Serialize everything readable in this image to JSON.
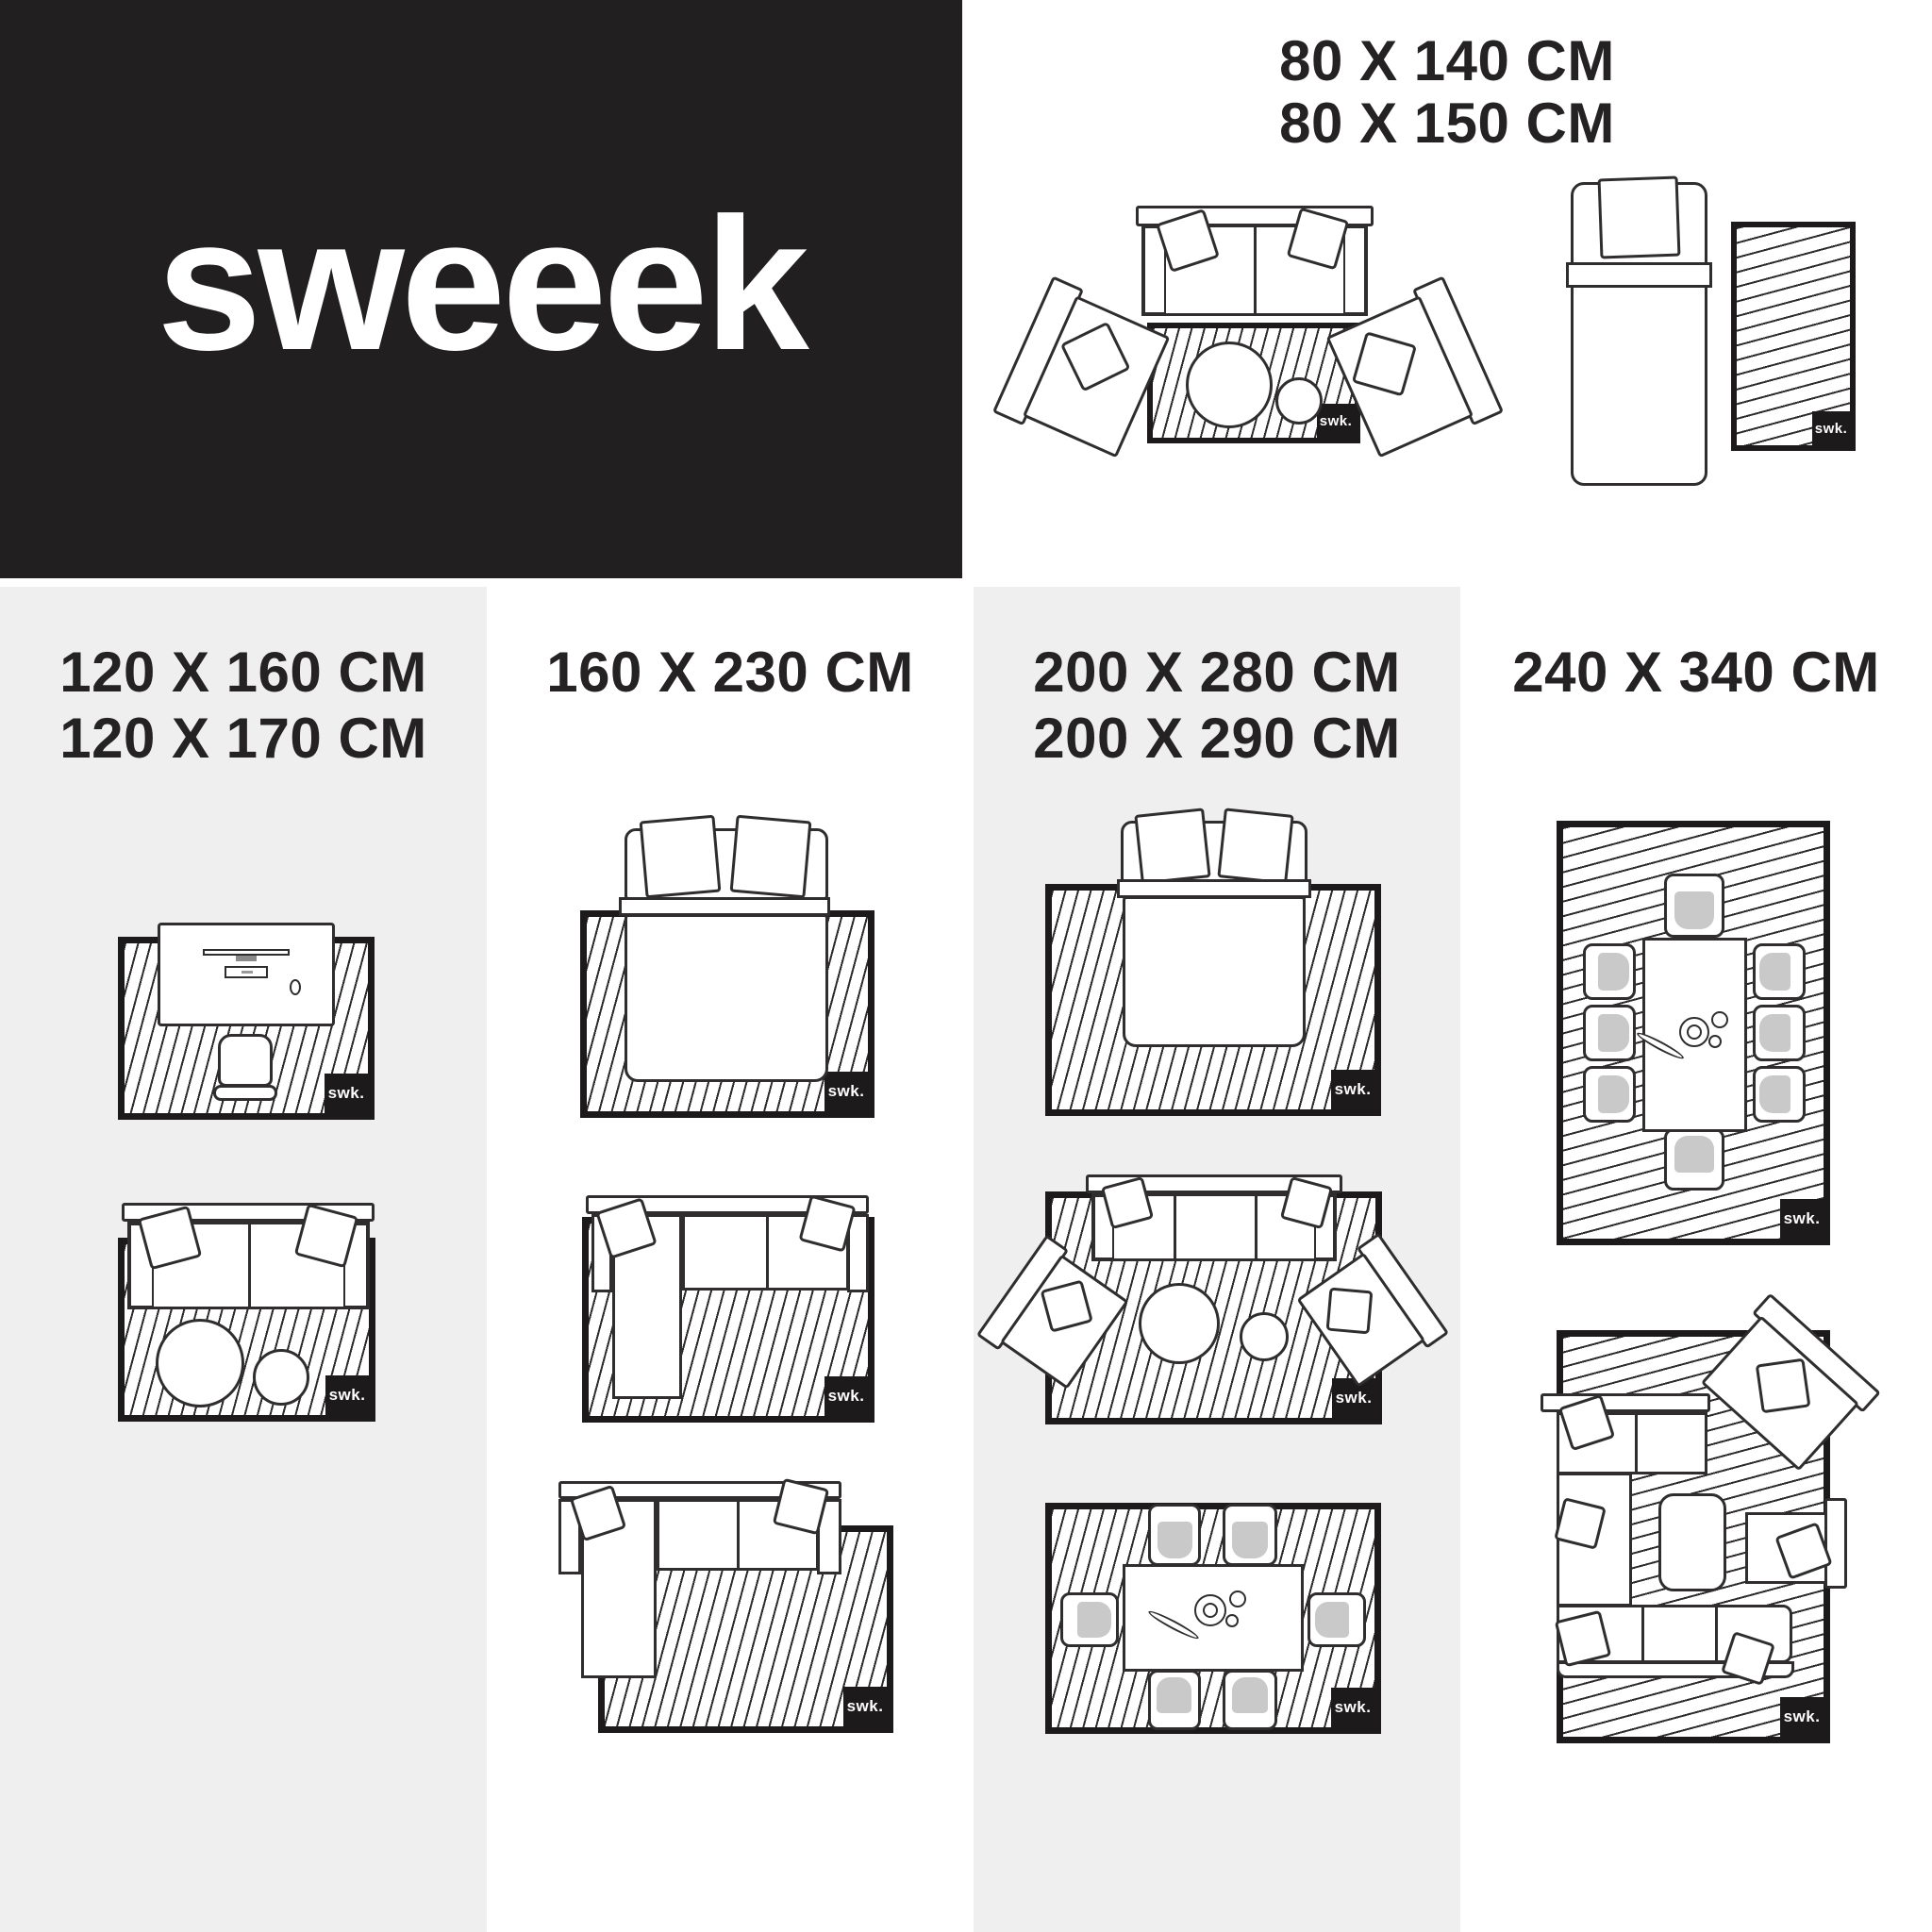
{
  "brand": {
    "logo": "sweeek",
    "badge": "swk."
  },
  "palette": {
    "panel_black": "#211f1f",
    "column_gray": "#efefef",
    "ink": "#242222",
    "cushion_gray": "#c9c9c9"
  },
  "top_right": {
    "sizes": [
      "80 X 140 CM",
      "80 X 150 CM"
    ],
    "diagrams": [
      "sofa-with-two-armchairs-and-small-rug",
      "single-bed-with-bedside-rug"
    ]
  },
  "columns": [
    {
      "sizes": [
        "120 X 160 CM",
        "120 X 170 CM"
      ],
      "bg": "gray",
      "diagrams": [
        "office-desk-on-rug",
        "two-seat-sofa-on-rug"
      ]
    },
    {
      "sizes": [
        "160 X 230 CM"
      ],
      "bg": "white",
      "diagrams": [
        "double-bed-on-rug",
        "corner-sofa-on-rug",
        "offset-chaise-sofa-on-rug"
      ]
    },
    {
      "sizes": [
        "200 X 280 CM",
        "200 X 290 CM"
      ],
      "bg": "gray",
      "diagrams": [
        "double-bed-on-large-rug",
        "sofa-with-two-armchairs-on-rug",
        "six-seat-dining-table-on-rug"
      ]
    },
    {
      "sizes": [
        "240 X 340 CM"
      ],
      "bg": "white",
      "diagrams": [
        "eight-seat-dining-table-on-rug",
        "living-room-corner-set-on-rug"
      ]
    }
  ]
}
